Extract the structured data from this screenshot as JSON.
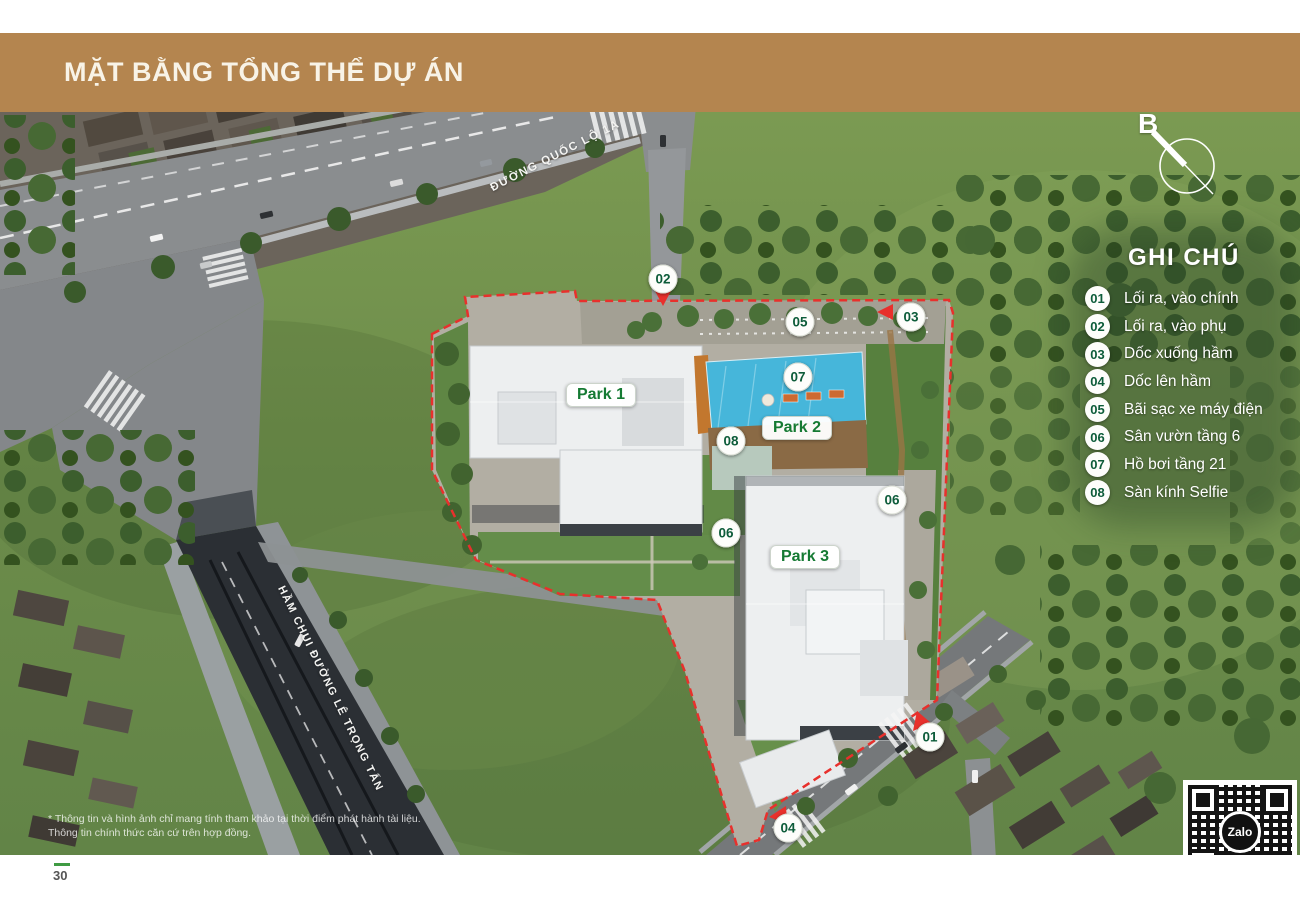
{
  "header": {
    "title": "MẶT BẰNG TỔNG THỂ DỰ ÁN"
  },
  "compass": {
    "letter": "B"
  },
  "legend": {
    "title": "GHI CHÚ",
    "items": [
      {
        "num": "01",
        "label": "Lối ra, vào chính"
      },
      {
        "num": "02",
        "label": "Lối ra, vào phụ"
      },
      {
        "num": "03",
        "label": "Dốc xuống hầm"
      },
      {
        "num": "04",
        "label": "Dốc lên hầm"
      },
      {
        "num": "05",
        "label": "Bãi sạc xe máy điện"
      },
      {
        "num": "06",
        "label": "Sân vườn tầng 6"
      },
      {
        "num": "07",
        "label": "Hồ bơi tầng 21"
      },
      {
        "num": "08",
        "label": "Sàn kính Selfie"
      }
    ]
  },
  "map": {
    "road_labels": [
      {
        "text": "ĐƯỜNG QUỐC LỘ 1A"
      },
      {
        "text": "HẦM CHUI ĐƯỜNG LÊ TRỌNG TẤN"
      }
    ],
    "area_labels": [
      {
        "text": "Park 1",
        "x": 601,
        "y": 395
      },
      {
        "text": "Park 2",
        "x": 797,
        "y": 428
      },
      {
        "text": "Park 3",
        "x": 805,
        "y": 557
      }
    ],
    "markers": [
      {
        "num": "02",
        "x": 663,
        "y": 279
      },
      {
        "num": "05",
        "x": 800,
        "y": 322
      },
      {
        "num": "03",
        "x": 911,
        "y": 317
      },
      {
        "num": "07",
        "x": 798,
        "y": 377
      },
      {
        "num": "08",
        "x": 731,
        "y": 441
      },
      {
        "num": "06",
        "x": 892,
        "y": 500
      },
      {
        "num": "06",
        "x": 726,
        "y": 533
      },
      {
        "num": "01",
        "x": 930,
        "y": 737
      },
      {
        "num": "04",
        "x": 788,
        "y": 828
      }
    ]
  },
  "footer": {
    "disclaimer_line1": "* Thông tin và hình ảnh chỉ mang tính tham khảo tại thời điểm phát hành tài liệu.",
    "disclaimer_line2": "Thông tin chính thức căn cứ trên hợp đồng.",
    "page_number": "30"
  },
  "qr": {
    "logo_text": "Zalo"
  },
  "colors": {
    "header_band": "#b4854f",
    "legend_number_green": "#0d5c3a",
    "park_label_green": "#157a33",
    "boundary_red": "#e8302c"
  }
}
